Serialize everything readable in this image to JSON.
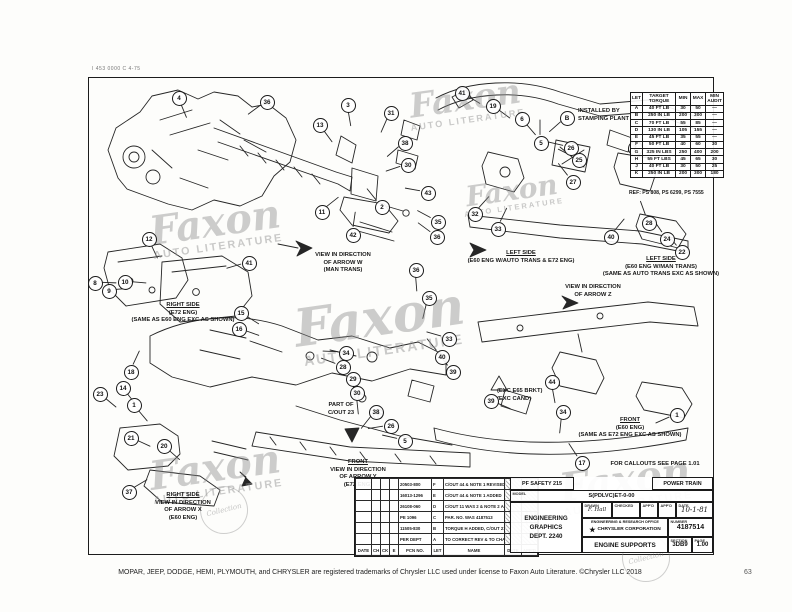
{
  "page": {
    "corner_mark": "I 453 0000 C 4-75",
    "footer": "MOPAR, JEEP, DODGE, HEMI, PLYMOUTH, and CHRYSLER are registered trademarks of Chrysler LLC used under license to Faxon Auto Literature. ©Chrysler LLC 2018",
    "page_number": "63"
  },
  "watermark": {
    "script": "Faxon",
    "subtitle": "AUTO LITERATURE",
    "stamp": "Collection",
    "instances": [
      {
        "x": 150,
        "y": 205,
        "s": 40
      },
      {
        "x": 408,
        "y": 84,
        "s": 34
      },
      {
        "x": 295,
        "y": 295,
        "s": 52
      },
      {
        "x": 150,
        "y": 450,
        "s": 40
      },
      {
        "x": 560,
        "y": 462,
        "s": 40
      },
      {
        "x": 462,
        "y": 178,
        "s": 28
      }
    ],
    "stamps": [
      {
        "x": 200,
        "y": 486
      },
      {
        "x": 622,
        "y": 534
      }
    ]
  },
  "torque_table": {
    "headers": [
      "LET",
      "TARGET TORQUE",
      "MIN",
      "MAX",
      "MIN AUDIT"
    ],
    "rows": [
      [
        "A",
        "40 FT LB",
        "30",
        "50",
        "—"
      ],
      [
        "B",
        "250 IN LB",
        "200",
        "300",
        "—"
      ],
      [
        "C",
        "70 FT LB",
        "55",
        "85",
        "—"
      ],
      [
        "D",
        "130 IN LB",
        "105",
        "155",
        "—"
      ],
      [
        "E",
        "45 FT LB",
        "35",
        "55",
        "—"
      ],
      [
        "F",
        "50 FT LB",
        "40",
        "60",
        "30"
      ],
      [
        "G",
        "325 IN LBS",
        "250",
        "400",
        "200"
      ],
      [
        "H",
        "55 FT LBS",
        "45",
        "65",
        "30"
      ],
      [
        "J",
        "40 FT LB",
        "30",
        "50",
        "25"
      ],
      [
        "K",
        "250 IN LB",
        "200",
        "300",
        "180"
      ]
    ],
    "ref": "REF: PS 808, PS 6299, PS 7555"
  },
  "view_labels": [
    {
      "id": "installed-by-stamping",
      "x": 578,
      "y": 108,
      "align": "left",
      "lines": [
        {
          "t": "INSTALLED BY"
        },
        {
          "t": "STAMPING PLANT"
        }
      ]
    },
    {
      "id": "view-arrow-w",
      "x": 343,
      "y": 252,
      "align": "center",
      "lines": [
        {
          "t": "VIEW IN DIRECTION"
        },
        {
          "t": "OF ARROW W"
        },
        {
          "t": "(MAN TRANS)"
        }
      ]
    },
    {
      "id": "left-side-auto-trans",
      "x": 521,
      "y": 250,
      "align": "center",
      "lines": [
        {
          "t": "LEFT SIDE",
          "u": true
        },
        {
          "t": "(E60 ENG W/AUTO TRANS & E72 ENG)"
        }
      ]
    },
    {
      "id": "left-side-man-trans",
      "x": 661,
      "y": 256,
      "align": "center",
      "lines": [
        {
          "t": "LEFT SIDE",
          "u": true
        },
        {
          "t": "(E60 ENG W/MAN TRANS)"
        },
        {
          "t": "(SAME AS AUTO TRANS EXC AS SHOWN)"
        }
      ]
    },
    {
      "id": "view-arrow-z",
      "x": 593,
      "y": 284,
      "align": "center",
      "lines": [
        {
          "t": "VIEW IN DIRECTION"
        },
        {
          "t": "OF ARROW Z"
        }
      ]
    },
    {
      "id": "right-side-e72",
      "x": 183,
      "y": 302,
      "align": "center",
      "lines": [
        {
          "t": "RIGHT SIDE",
          "u": true
        },
        {
          "t": "(E72 ENG)"
        },
        {
          "t": "(SAME AS E60 ENG EXC AS SHOWN)"
        }
      ]
    },
    {
      "id": "exc-e65-brkt",
      "x": 497,
      "y": 388,
      "align": "left",
      "lines": [
        {
          "t": "(EXC E65 BRKT)"
        },
        {
          "t": "(EXC CAND)"
        }
      ]
    },
    {
      "id": "part-of-cout-23",
      "x": 341,
      "y": 402,
      "align": "center",
      "lines": [
        {
          "t": "PART OF"
        },
        {
          "t": "C/OUT 23"
        }
      ]
    },
    {
      "id": "front-e60",
      "x": 630,
      "y": 417,
      "align": "center",
      "lines": [
        {
          "t": "FRONT",
          "u": true
        },
        {
          "t": "(E60 ENG)"
        },
        {
          "t": "(SAME AS E72 ENG EXC AS SHOWN)"
        }
      ]
    },
    {
      "id": "front-arrow-y",
      "x": 358,
      "y": 459,
      "align": "center",
      "lines": [
        {
          "t": "FRONT",
          "u": true
        },
        {
          "t": "VIEW IN DIRECTION"
        },
        {
          "t": "OF ARROW Y"
        },
        {
          "t": "(E72 ENG)"
        }
      ]
    },
    {
      "id": "right-side-arrow-x",
      "x": 183,
      "y": 492,
      "align": "center",
      "lines": [
        {
          "t": "RIGHT SIDE",
          "u": true
        },
        {
          "t": "VIEW IN DIRECTION"
        },
        {
          "t": "OF ARROW X"
        },
        {
          "t": "(E60 ENG)"
        }
      ]
    },
    {
      "id": "callouts-note",
      "x": 655,
      "y": 461,
      "align": "center",
      "lines": [
        {
          "t": "FOR CALLOUTS SEE PAGE 1.01"
        }
      ]
    }
  ],
  "balloons": [
    {
      "n": "4",
      "x": 178,
      "y": 97
    },
    {
      "n": "36",
      "x": 266,
      "y": 101
    },
    {
      "n": "3",
      "x": 347,
      "y": 104
    },
    {
      "n": "13",
      "x": 319,
      "y": 124
    },
    {
      "n": "31",
      "x": 390,
      "y": 112
    },
    {
      "n": "38",
      "x": 404,
      "y": 142
    },
    {
      "n": "30",
      "x": 407,
      "y": 164
    },
    {
      "n": "41",
      "x": 461,
      "y": 92
    },
    {
      "n": "19",
      "x": 492,
      "y": 105
    },
    {
      "n": "6",
      "x": 521,
      "y": 118
    },
    {
      "n": "B",
      "x": 566,
      "y": 117
    },
    {
      "n": "5",
      "x": 540,
      "y": 142
    },
    {
      "n": "26",
      "x": 570,
      "y": 147
    },
    {
      "n": "25",
      "x": 578,
      "y": 159
    },
    {
      "n": "27",
      "x": 572,
      "y": 181
    },
    {
      "n": "7",
      "x": 634,
      "y": 147
    },
    {
      "n": "11",
      "x": 321,
      "y": 211
    },
    {
      "n": "2",
      "x": 381,
      "y": 206
    },
    {
      "n": "42",
      "x": 352,
      "y": 234
    },
    {
      "n": "43",
      "x": 427,
      "y": 192
    },
    {
      "n": "32",
      "x": 474,
      "y": 213
    },
    {
      "n": "35",
      "x": 437,
      "y": 221
    },
    {
      "n": "33",
      "x": 497,
      "y": 228
    },
    {
      "n": "36",
      "x": 436,
      "y": 236
    },
    {
      "n": "28",
      "x": 648,
      "y": 222
    },
    {
      "n": "24",
      "x": 666,
      "y": 238
    },
    {
      "n": "22",
      "x": 681,
      "y": 251
    },
    {
      "n": "40",
      "x": 610,
      "y": 236
    },
    {
      "n": "12",
      "x": 148,
      "y": 238
    },
    {
      "n": "41",
      "x": 248,
      "y": 262
    },
    {
      "n": "10",
      "x": 124,
      "y": 281
    },
    {
      "n": "9",
      "x": 108,
      "y": 290
    },
    {
      "n": "8",
      "x": 94,
      "y": 282
    },
    {
      "n": "15",
      "x": 240,
      "y": 312
    },
    {
      "n": "16",
      "x": 238,
      "y": 328
    },
    {
      "n": "36",
      "x": 415,
      "y": 269
    },
    {
      "n": "35",
      "x": 428,
      "y": 297
    },
    {
      "n": "34",
      "x": 345,
      "y": 352
    },
    {
      "n": "18",
      "x": 130,
      "y": 371
    },
    {
      "n": "14",
      "x": 122,
      "y": 387
    },
    {
      "n": "23",
      "x": 99,
      "y": 393
    },
    {
      "n": "1",
      "x": 133,
      "y": 404
    },
    {
      "n": "21",
      "x": 130,
      "y": 437
    },
    {
      "n": "20",
      "x": 163,
      "y": 445
    },
    {
      "n": "37",
      "x": 128,
      "y": 491
    },
    {
      "n": "33",
      "x": 448,
      "y": 338
    },
    {
      "n": "40",
      "x": 441,
      "y": 356
    },
    {
      "n": "39",
      "x": 452,
      "y": 371
    },
    {
      "n": "28",
      "x": 342,
      "y": 366
    },
    {
      "n": "29",
      "x": 352,
      "y": 378
    },
    {
      "n": "30",
      "x": 356,
      "y": 392
    },
    {
      "n": "38",
      "x": 375,
      "y": 411
    },
    {
      "n": "26",
      "x": 390,
      "y": 425
    },
    {
      "n": "5",
      "x": 404,
      "y": 440
    },
    {
      "n": "44",
      "x": 551,
      "y": 381
    },
    {
      "n": "39",
      "x": 490,
      "y": 400
    },
    {
      "n": "34",
      "x": 562,
      "y": 411
    },
    {
      "n": "1",
      "x": 676,
      "y": 414
    },
    {
      "n": "17",
      "x": 581,
      "y": 462
    }
  ],
  "revision_table": {
    "rows": [
      {
        "pcn": "20503-800",
        "let": "F",
        "desc": "C/OUT 44 & NOTE 1 REVISED"
      },
      {
        "pcn": "16013-1296",
        "let": "E",
        "desc": "C/OUT 44 & NOTE 1 ADDED"
      },
      {
        "pcn": "26108-060",
        "let": "D",
        "desc": "C/OUT 11 WAS 2 & NOTE 2 ADDED"
      },
      {
        "pcn": "PE 1096",
        "let": "C",
        "desc": "PAR. NO. WAS 4187513"
      },
      {
        "pcn": "11505-830",
        "let": "B",
        "desc": "TORQUE H ADDED, C/OUT 21 WAS TORQUE B"
      },
      {
        "pcn": "PER DEPT",
        "let": "A",
        "desc": "TO CORRECT REV & TO CHANGE REV"
      }
    ],
    "footer": [
      "DATE",
      "CH",
      "CK",
      "E",
      "PCN NO.",
      "LET",
      "NAME",
      "DATE",
      "APP'D"
    ]
  },
  "title_block": {
    "pf_safety": "PF SAFETY 215",
    "power_train": "POWER TRAIN",
    "model_label": "MODEL",
    "model": "S(PDLVC)ET-0-00",
    "org1": "ENGINEERING",
    "org2": "GRAPHICS",
    "dept": "DEPT. 2240",
    "drawn_label": "DRAWN",
    "checked_label": "CHECKED",
    "app_label": "APP'D",
    "date_label": "DATE",
    "drawn_sig": "F. Hall",
    "date": "10-1-81",
    "office": "ENGINEERING & RESEARCH OFFICE",
    "company": "CHRYSLER CORPORATION",
    "number_label": "NUMBER",
    "number": "4187514",
    "title": "ENGINE SUPPORTS",
    "section_label": "SECTION",
    "section": "3DB9",
    "page_label": "PAGE",
    "page": "1.00"
  }
}
